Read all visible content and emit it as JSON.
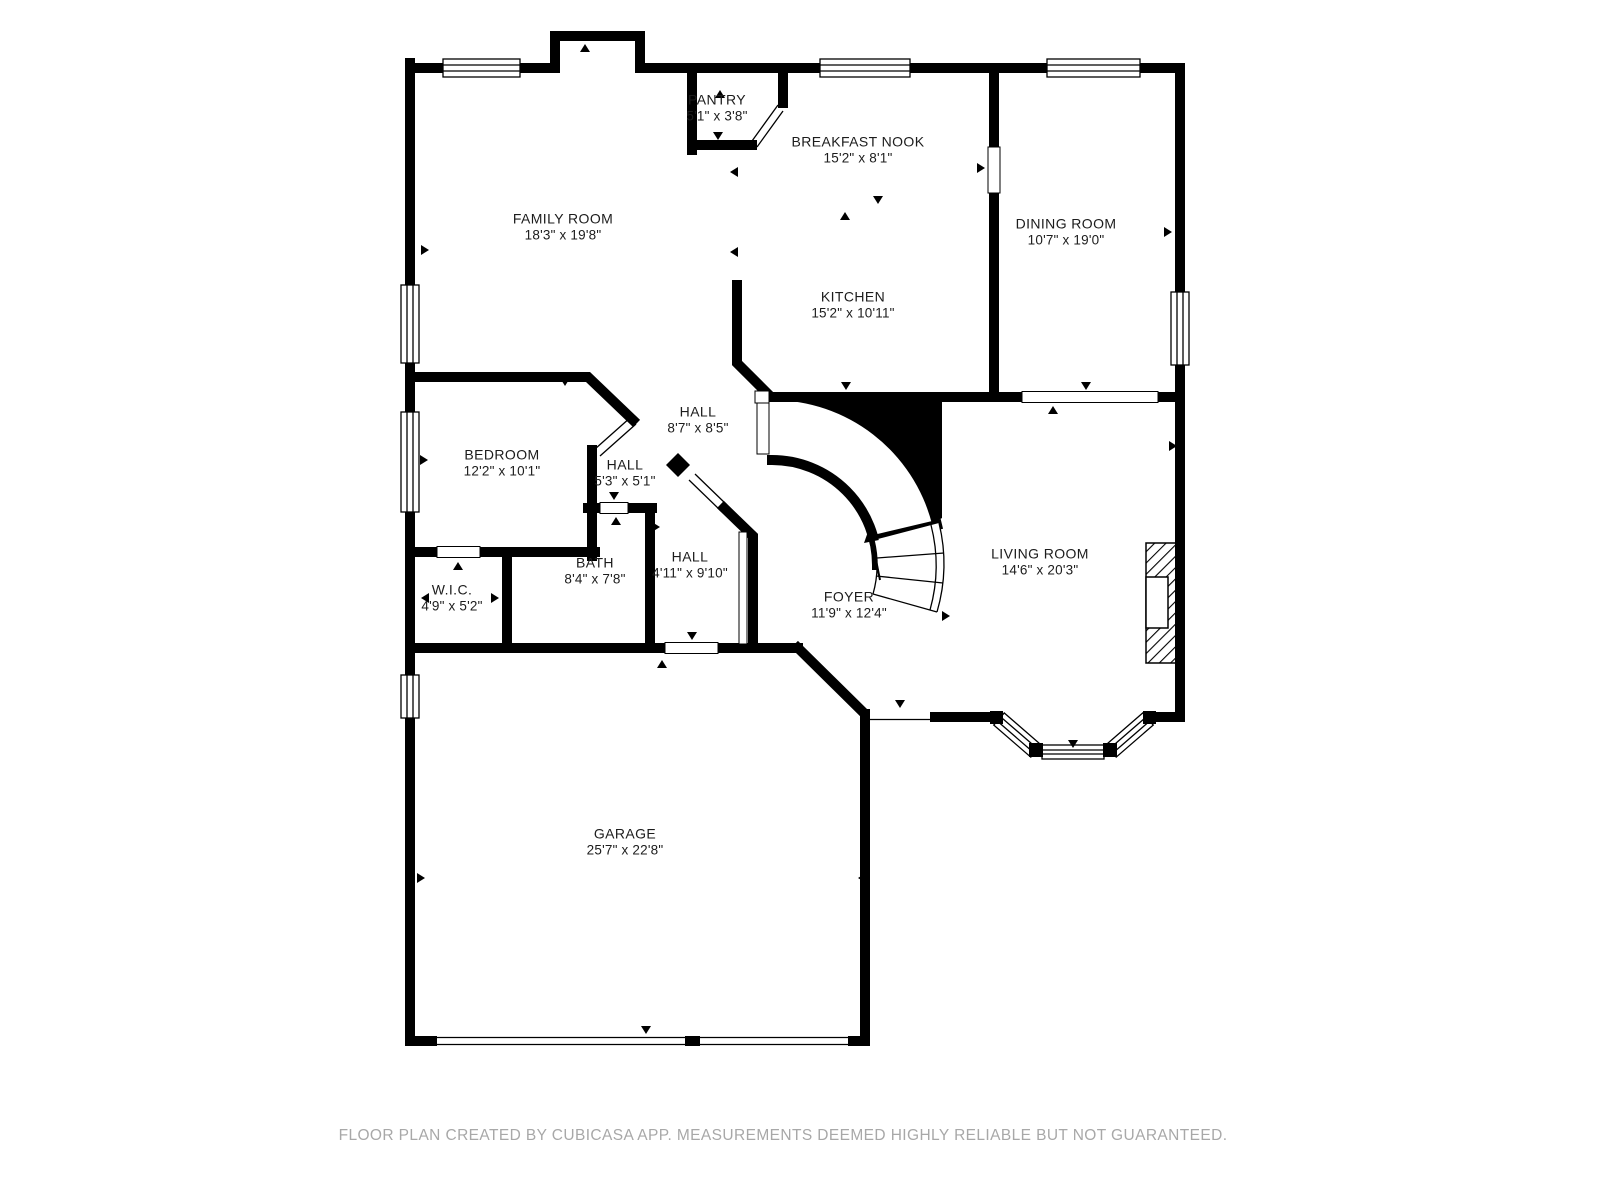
{
  "title": "First floor plan",
  "colors": {
    "wall": "#000000",
    "background": "#ffffff",
    "label_text": "#1c1c1c",
    "footer_text": "#a8a8a8"
  },
  "footer": "FLOOR PLAN CREATED BY CUBICASA APP. MEASUREMENTS DEEMED HIGHLY RELIABLE BUT NOT GUARANTEED.",
  "rooms": [
    {
      "name": "PANTRY",
      "dims": "5'1\" x 3'8\""
    },
    {
      "name": "BREAKFAST NOOK",
      "dims": "15'2\" x 8'1\""
    },
    {
      "name": "FAMILY ROOM",
      "dims": "18'3\" x 19'8\""
    },
    {
      "name": "DINING ROOM",
      "dims": "10'7\" x 19'0\""
    },
    {
      "name": "KITCHEN",
      "dims": "15'2\" x 10'11\""
    },
    {
      "name": "HALL",
      "dims": "8'7\" x 8'5\""
    },
    {
      "name": "HALL",
      "dims": "5'3\" x 5'1\""
    },
    {
      "name": "BEDROOM",
      "dims": "12'2\" x 10'1\""
    },
    {
      "name": "W.I.C.",
      "dims": "4'9\" x 5'2\""
    },
    {
      "name": "BATH",
      "dims": "8'4\" x 7'8\""
    },
    {
      "name": "HALL",
      "dims": "4'11\" x 9'10\""
    },
    {
      "name": "FOYER",
      "dims": "11'9\" x 12'4\""
    },
    {
      "name": "LIVING ROOM",
      "dims": "14'6\" x 20'3\""
    },
    {
      "name": "GARAGE",
      "dims": "25'7\" x 22'8\""
    }
  ]
}
